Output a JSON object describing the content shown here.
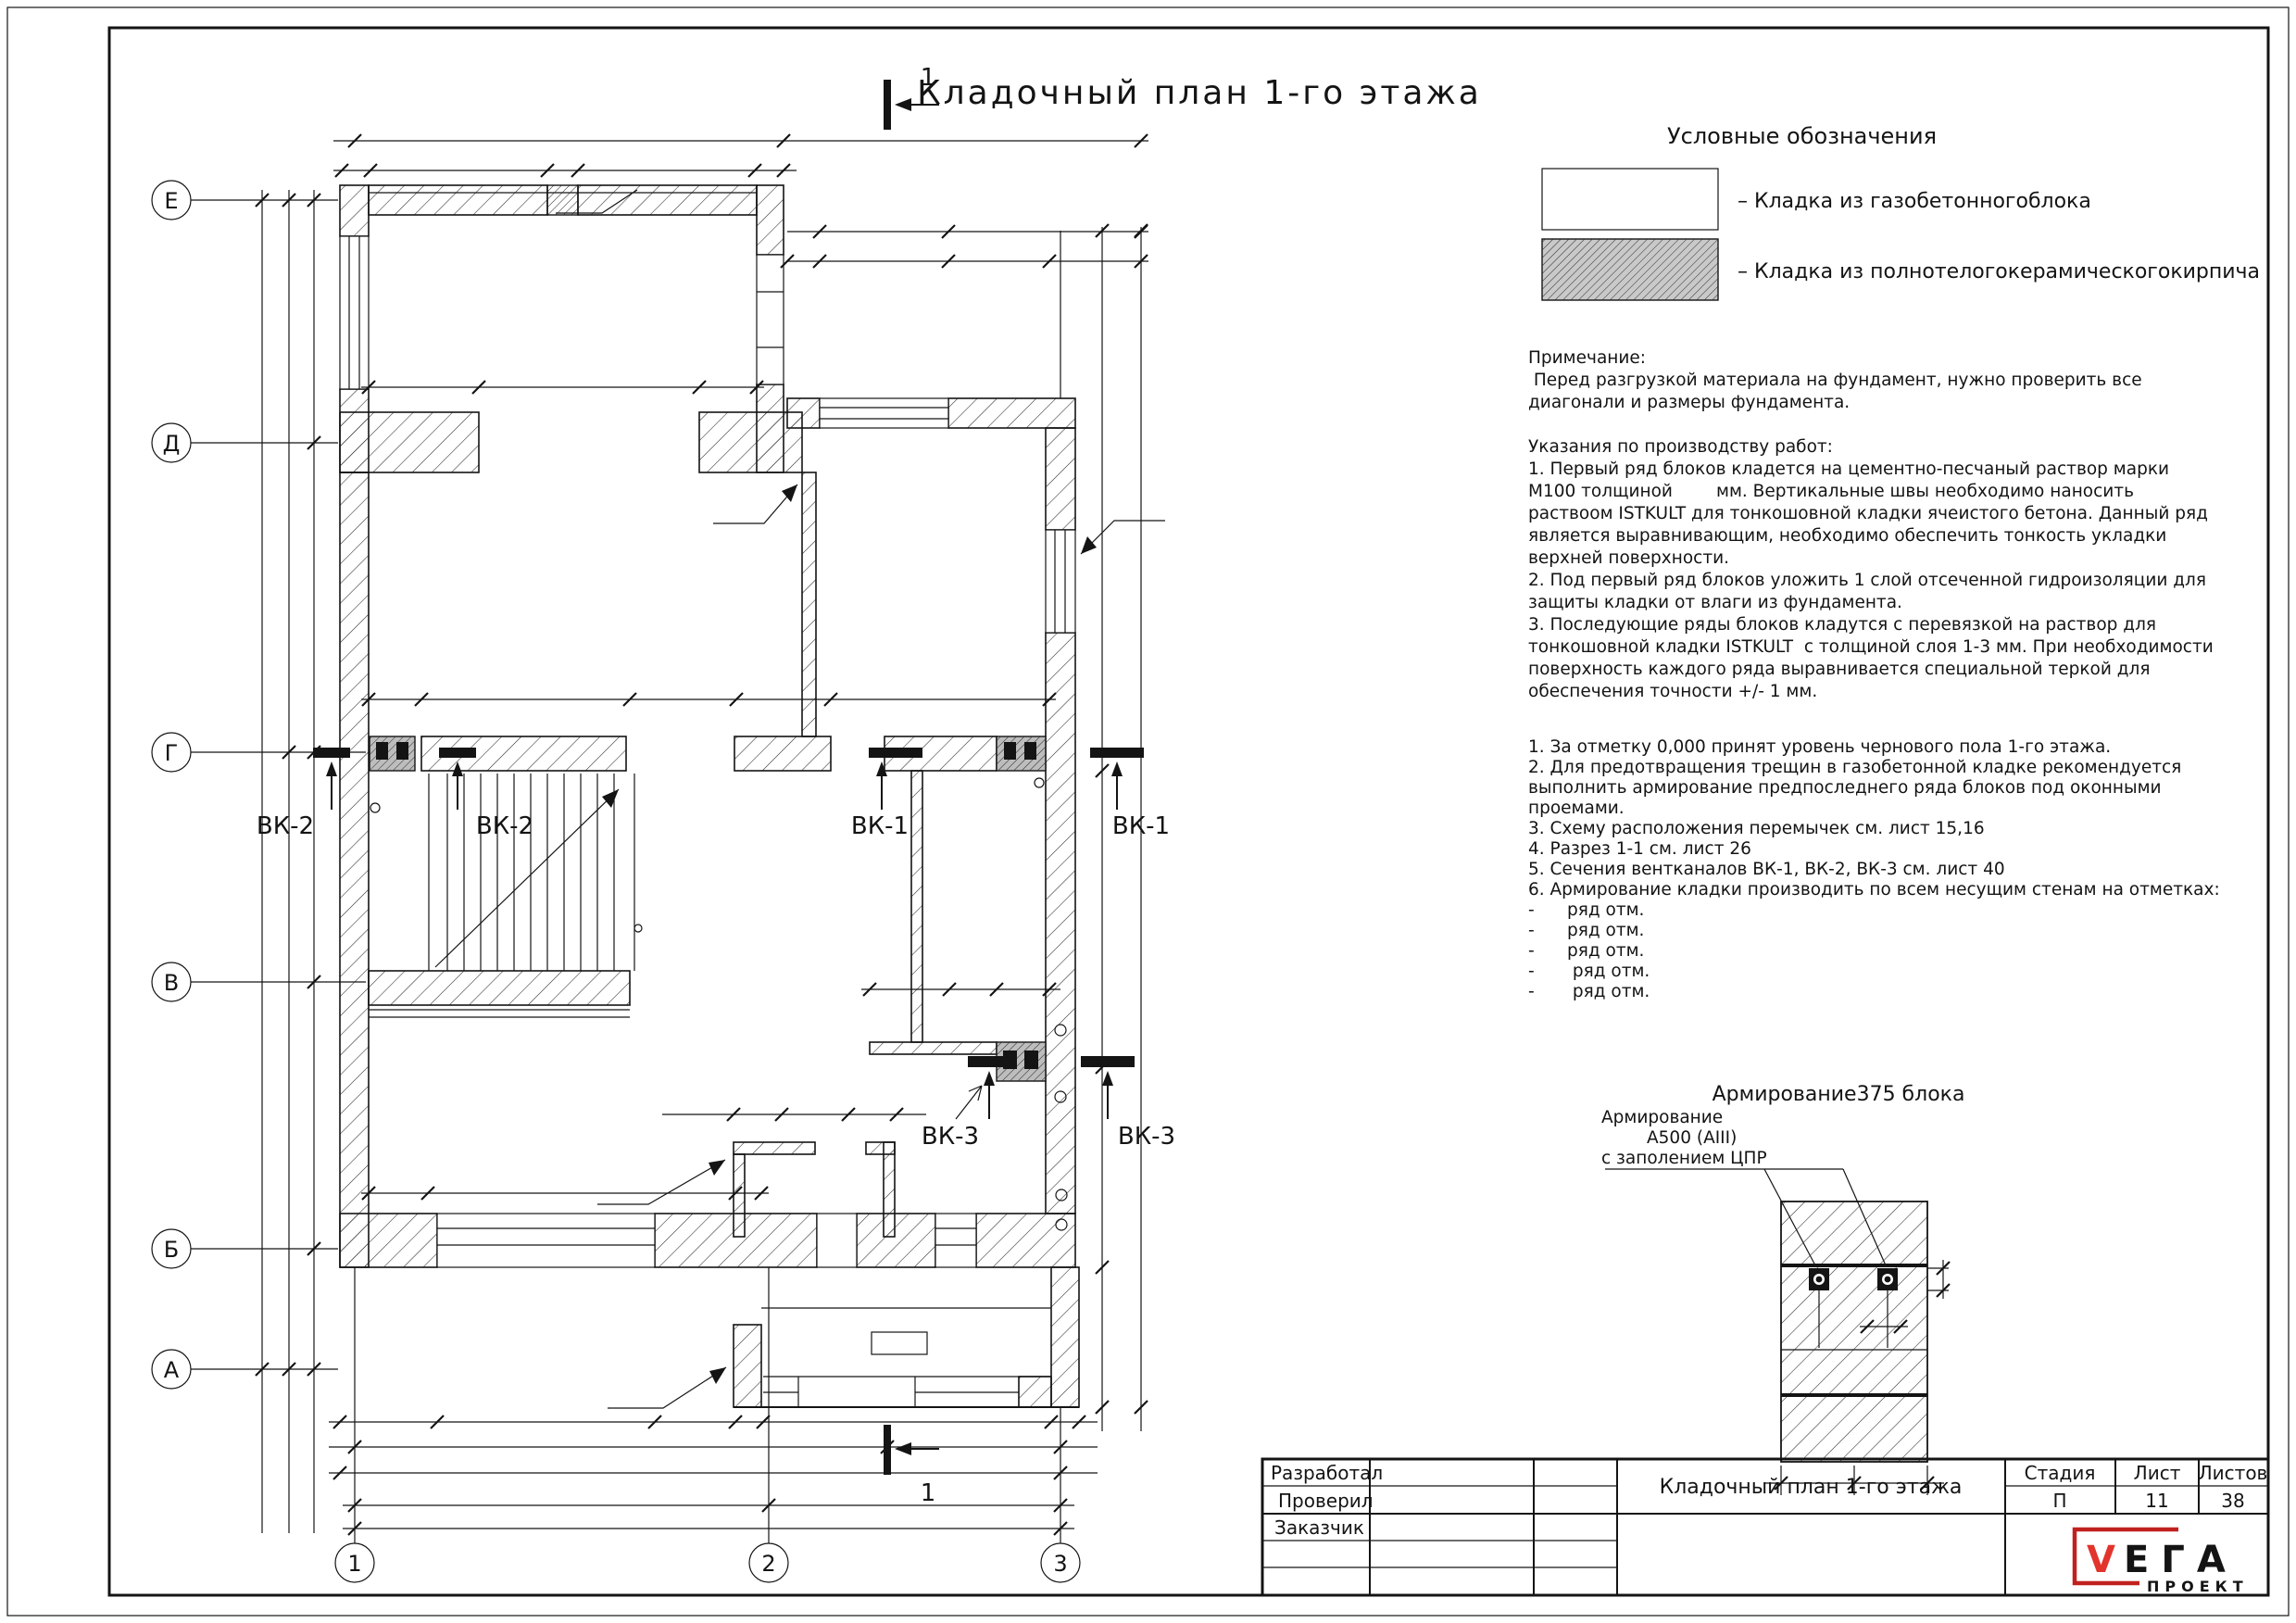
{
  "sheet": {
    "title": "Кладочный план 1-го этажа",
    "section_label": "1"
  },
  "axes": {
    "rows": [
      "Е",
      "Д",
      "Г",
      "В",
      "Б",
      "А"
    ],
    "cols": [
      "1",
      "2",
      "3"
    ]
  },
  "vents": {
    "vk1": "ВК-1",
    "vk2": "ВК-2",
    "vk3": "ВК-3"
  },
  "legend": {
    "heading": "Условные обозначения",
    "items": [
      {
        "label": "– Кладка из газобетонногоблока"
      },
      {
        "label": "– Кладка из полнотелогокерамическогокирпича"
      }
    ]
  },
  "notes": {
    "lines": [
      "Примечание:",
      " Перед разгрузкой материала на фундамент, нужно проверить все",
      "диагонали и размеры фундамента.",
      "",
      "Указания по производству работ:",
      "1. Первый ряд блоков кладется на цементно-песчаный раствор марки",
      "М100 толщиной        мм. Вертикальные швы необходимо наносить",
      "раствоом ISTKULT для тонкошовной кладки ячеистого бетона. Данный ряд",
      "является выравнивающим, необходимо обеспечить тонкость укладки",
      "верхней поверхности.",
      "2. Под первый ряд блоков уложить 1 слой отсеченной гидроизоляции для",
      "защиты кладки от влаги из фундамента.",
      "3. Последующие ряды блоков кладутся с перевязкой на раствор для",
      "тонкошовной кладки ISTKULT  с толщиной слоя 1-3 мм. При необходимости",
      "поверхность каждого ряда выравнивается специальной теркой для",
      "обеспечения точности +/- 1 мм."
    ]
  },
  "general_notes": {
    "lines": [
      "1. За отметку 0,000 принят уровень чернового пола 1-го этажа.",
      "2. Для предотвращения трещин в газобетонной кладке рекомендуется",
      "выполнить армирование предпоследнего ряда блоков под оконными",
      "проемами.",
      "3. Схему расположения перемычек см. лист 15,16",
      "4. Разрез 1-1 см. лист 26",
      "5. Сечения вентканалов ВК-1, ВК-2, ВК-3 см. лист 40",
      "6. Армирование кладки производить по всем несущим стенам на отметках:",
      "-      ряд отм.",
      "-      ряд отм.",
      "-      ряд отм.",
      "-       ряд отм.",
      "-       ряд отм."
    ]
  },
  "detail": {
    "title": "Армирование375 блока",
    "callout": [
      "Армирование",
      "А500 (АIII)",
      "с заполением ЦПР"
    ]
  },
  "title_block": {
    "developed": "Разработал",
    "checked": "Проверил",
    "customer": "Заказчик",
    "doc_title": "Кладочный план 1-го этажа",
    "stage_label": "Стадия",
    "sheet_label": "Лист",
    "sheets_label": "Листов",
    "stage": "П",
    "sheet_no": "11",
    "sheets_total": "38"
  },
  "logo": {
    "v": "V",
    "rest": "ЕГА",
    "sub": "ПРОЕКТ"
  },
  "colors": {
    "ink": "#141414",
    "vent_gray": "#bdbdbd",
    "logo_red": "#c0211f",
    "logo_red_bright": "#e2342c"
  }
}
